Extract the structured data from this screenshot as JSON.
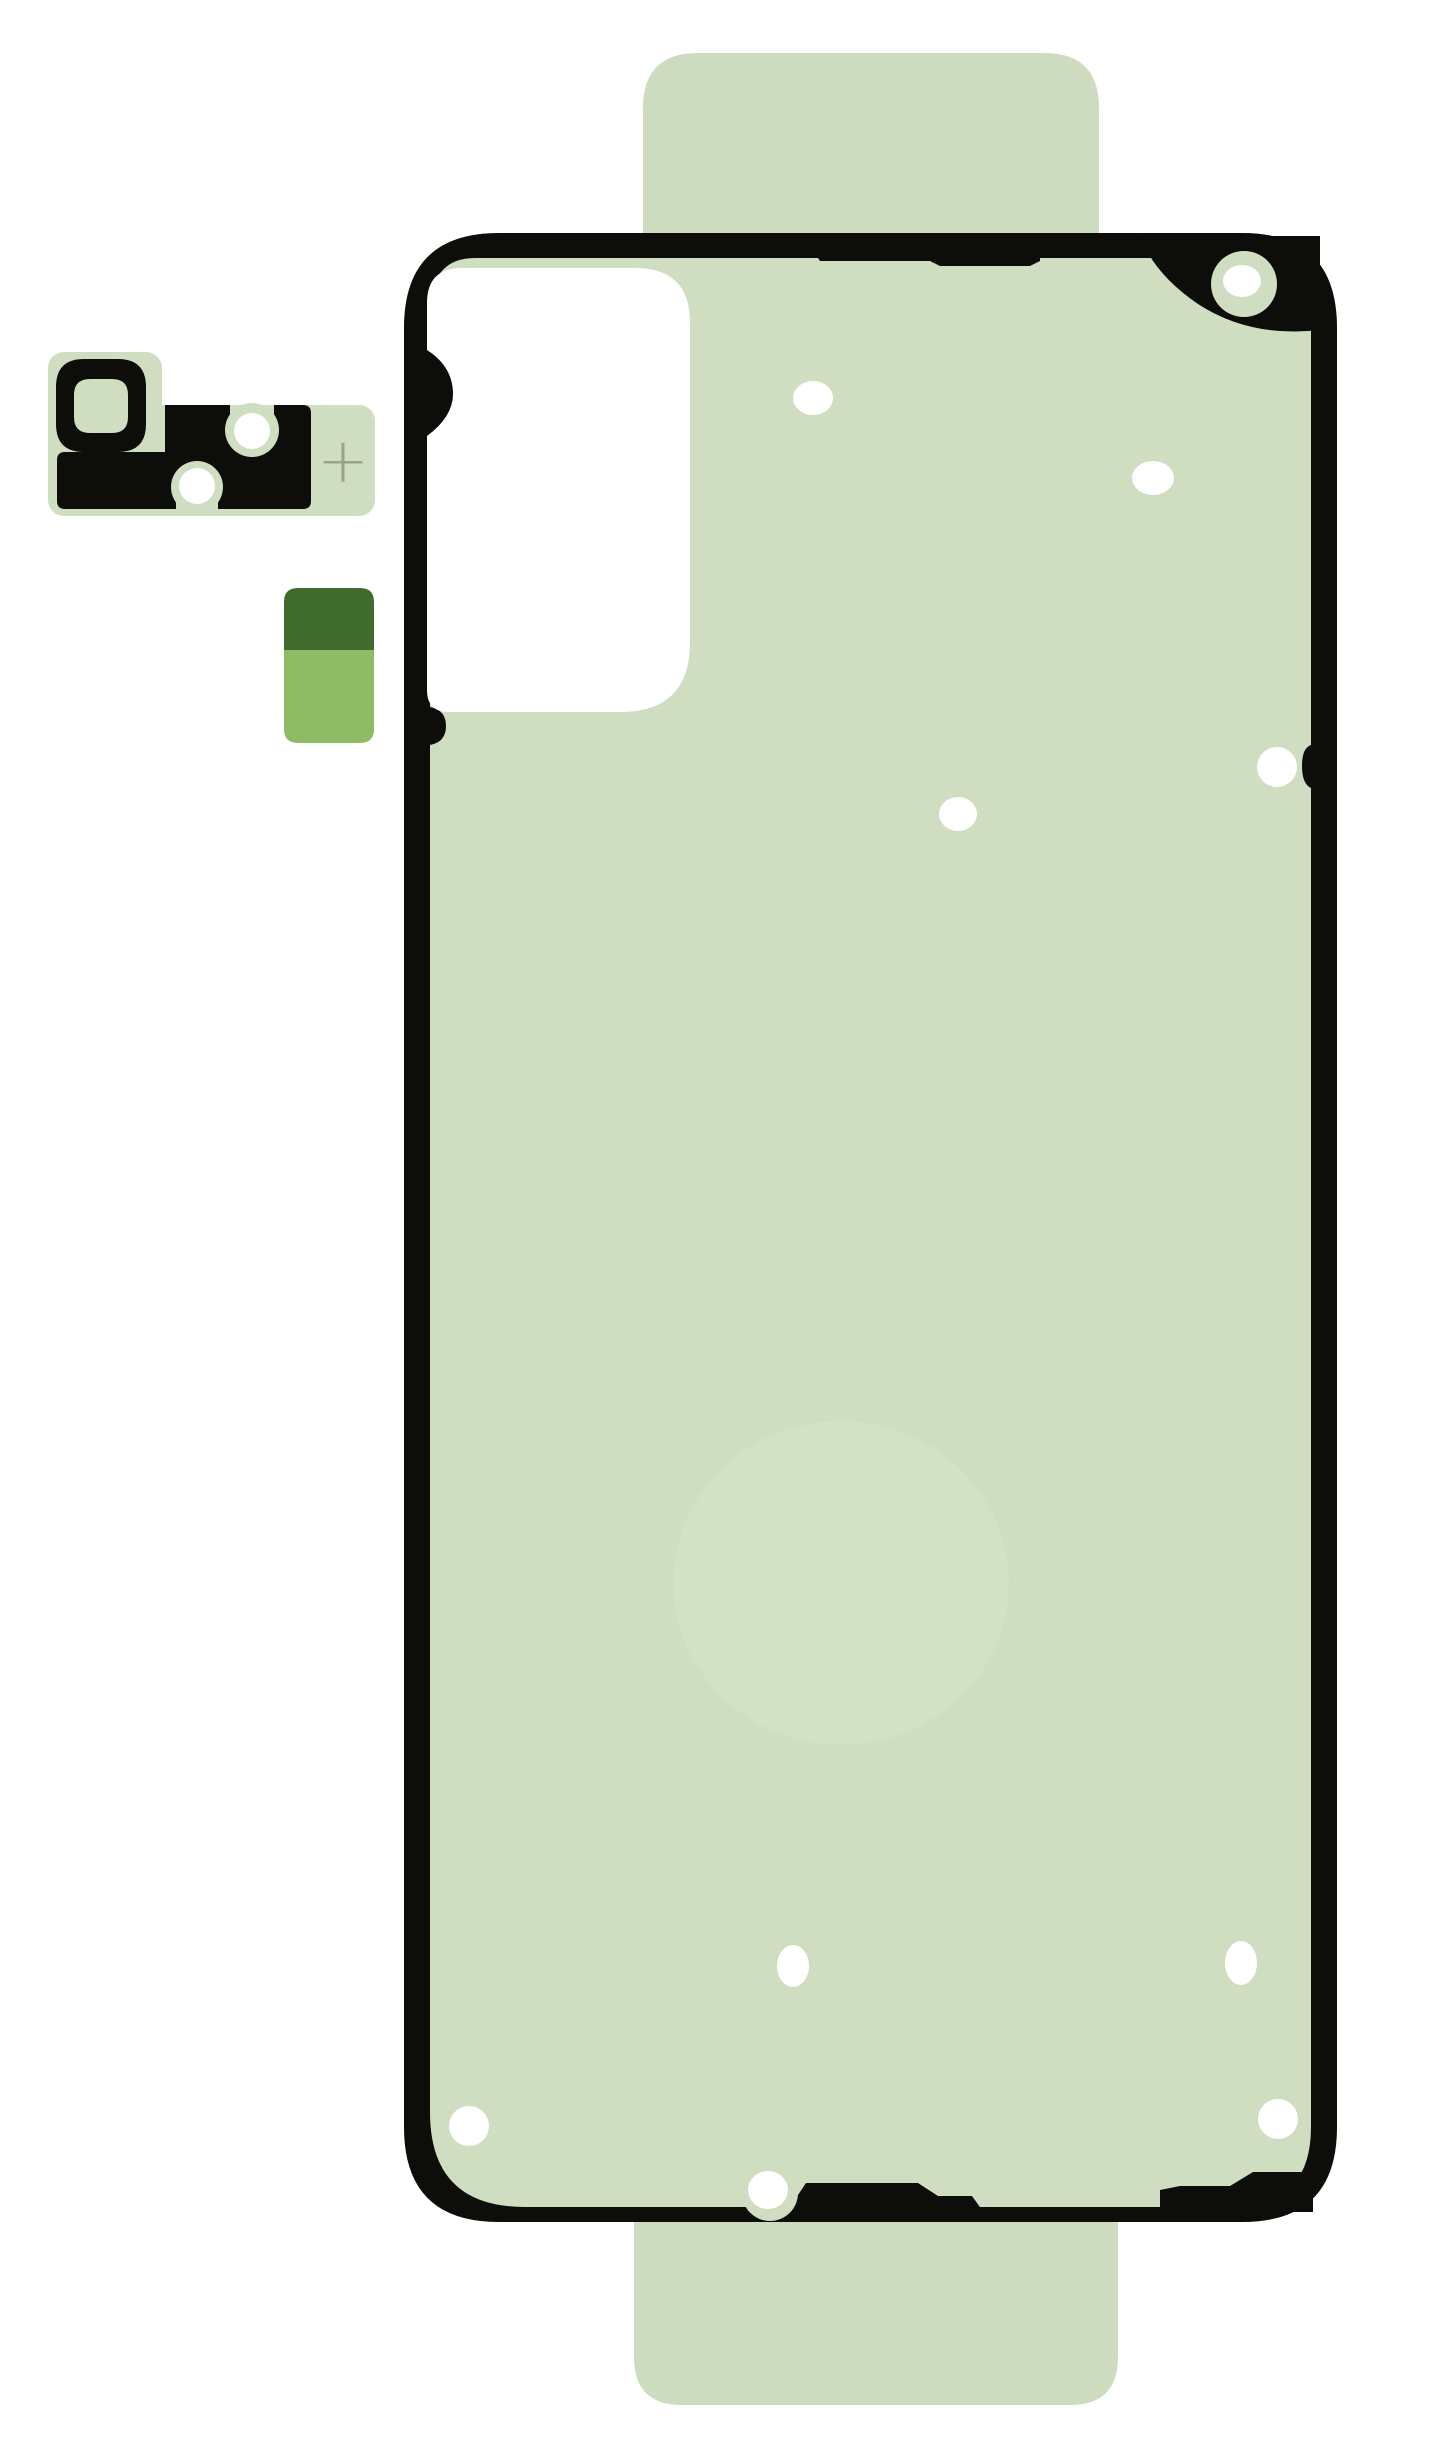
{
  "image": {
    "kind": "product-photo",
    "subject": "phone-back-cover-adhesive-sticker-set"
  },
  "colors": {
    "background": "#ffffff",
    "adhesive_green": "#cfdec1",
    "tab_green": "#cddcbe",
    "outline_black": "#0d0d0a",
    "cutout_white": "#ffffff",
    "hole_white": "#ffffff",
    "watermark_green": "#d7e3cb",
    "registration_mark": "#98a687",
    "square_dark_green": "#3f6b2d",
    "square_light_green": "#8ebc65"
  },
  "marks": {
    "registration_mark": "+"
  },
  "holes": {
    "main_sheet": [
      {
        "cx": 813,
        "cy": 398,
        "rx": 20,
        "ry": 17,
        "halo": 0
      },
      {
        "cx": 1153,
        "cy": 478,
        "rx": 21,
        "ry": 17,
        "halo": 0
      },
      {
        "cx": 1242,
        "cy": 281,
        "rx": 19,
        "ry": 16,
        "halo": 33
      },
      {
        "cx": 1277,
        "cy": 767,
        "rx": 20,
        "ry": 20,
        "halo": 0
      },
      {
        "cx": 958,
        "cy": 814,
        "rx": 19,
        "ry": 17,
        "halo": 0
      },
      {
        "cx": 793,
        "cy": 1966,
        "rx": 16,
        "ry": 21,
        "halo": 0
      },
      {
        "cx": 1241,
        "cy": 1963,
        "rx": 16,
        "ry": 22,
        "halo": 0
      },
      {
        "cx": 469,
        "cy": 2126,
        "rx": 20,
        "ry": 20,
        "halo": 30
      },
      {
        "cx": 1278,
        "cy": 2119,
        "rx": 20,
        "ry": 20,
        "halo": 0
      },
      {
        "cx": 768,
        "cy": 2190,
        "rx": 20,
        "ry": 19,
        "halo": 28
      }
    ],
    "camera_bezel": [
      {
        "cx": 252,
        "cy": 431,
        "rx": 18,
        "ry": 18,
        "halo": 0
      },
      {
        "cx": 197,
        "cy": 486,
        "rx": 18,
        "ry": 18,
        "halo": 0
      }
    ]
  }
}
